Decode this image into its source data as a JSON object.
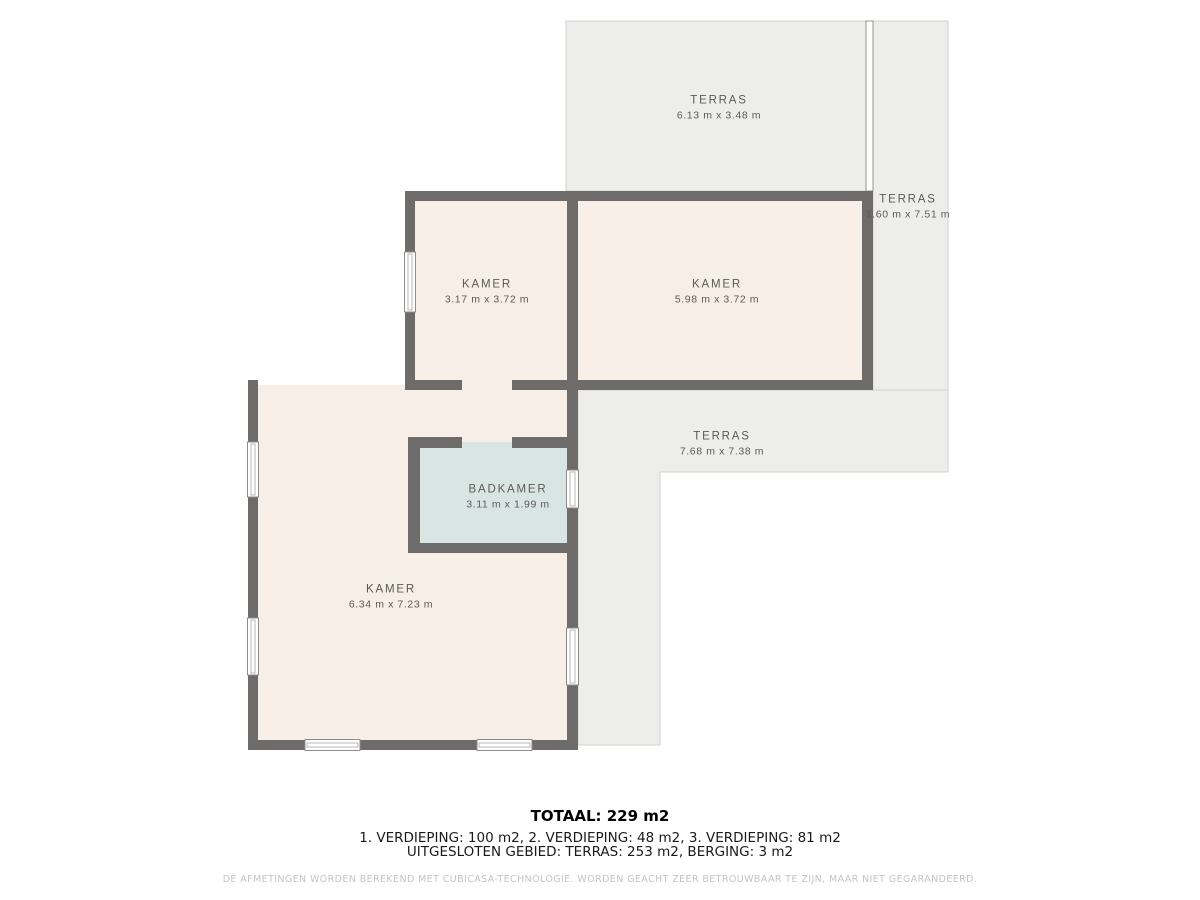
{
  "rooms": [
    {
      "id": "terras-top",
      "label": "TERRAS",
      "dims": "6.13 m x 3.48 m"
    },
    {
      "id": "terras-right",
      "label": "TERRAS",
      "dims": "1.60 m x 7.51 m"
    },
    {
      "id": "kamer-left",
      "label": "KAMER",
      "dims": "3.17 m x 3.72 m"
    },
    {
      "id": "kamer-right",
      "label": "KAMER",
      "dims": "5.98 m x 3.72 m"
    },
    {
      "id": "terras-middle",
      "label": "TERRAS",
      "dims": "7.68 m x 7.38 m"
    },
    {
      "id": "badkamer",
      "label": "BADKAMER",
      "dims": "3.11 m x 1.99 m"
    },
    {
      "id": "kamer-bottom",
      "label": "KAMER",
      "dims": "6.34 m x 7.23 m"
    }
  ],
  "summary": {
    "total": "TOTAAL: 229 m2",
    "floors": "1. VERDIEPING: 100 m2, 2. VERDIEPING: 48 m2, 3. VERDIEPING: 81 m2",
    "excluded": "UITGESLOTEN GEBIED: TERRAS: 253 m2, BERGING: 3 m2",
    "disclaimer": "DE AFMETINGEN WORDEN BEREKEND MET CUBICASA-TECHNOLOGIE. WORDEN GEACHT ZEER BETROUWBAAR TE ZIJN, MAAR NIET GEGARANDEERD."
  },
  "colors": {
    "wall": "#6e6c6a",
    "room_fill": "#f7eee8",
    "bathroom_fill": "#d9e5e3",
    "terrace_fill": "#ededec",
    "terrace_border": "#d2d1d0",
    "label_text": "#5c5a54",
    "summary_text": "#1a1a1a",
    "disclaimer_text": "#c5c4c2"
  }
}
